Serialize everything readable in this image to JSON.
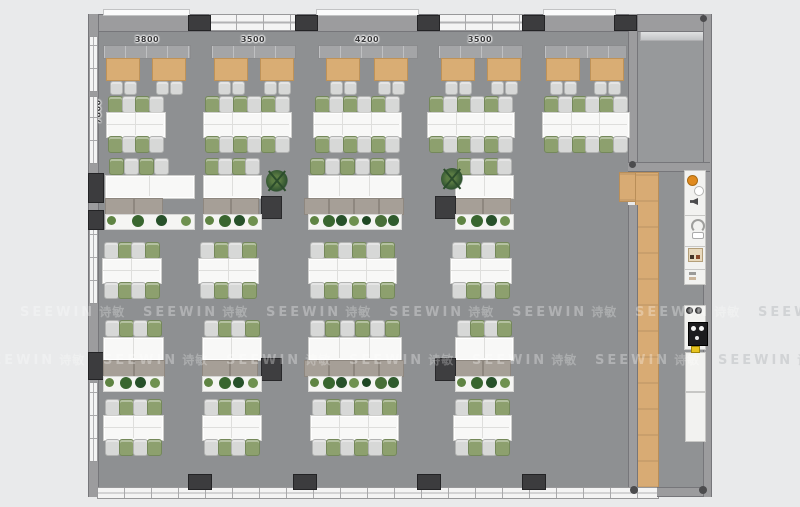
{
  "meta": {
    "type": "office-floor-plan-top-view"
  },
  "watermark": {
    "text": "SEEWIN",
    "cjk": "诗敏"
  },
  "dimensions": {
    "top": [
      "3800",
      "3500",
      "4200",
      "3500"
    ],
    "left": "7800"
  },
  "palette": {
    "bg": "#e9eaeb",
    "floor": "#8e9092",
    "room_floor": "#97999b",
    "wall": "#9c9c9e",
    "pillar": "#3c3c3e",
    "desk": "#f8f8f7",
    "chair_gray": "#d7d8d7",
    "chair_green": "#8da06e",
    "booth_table": "#d9ad74",
    "bench": "#a4a5a7",
    "cabinet": "#a69f97",
    "dark_cabinet": "#3e3e40",
    "wood": "#d8ab74",
    "planter": "#f5f5f3",
    "accent_orange": "#e08a1e",
    "window": "#f4f4f4"
  },
  "floorplan": {
    "booths": {
      "bench_y": 45,
      "bench_h": 12,
      "table_y": 58,
      "table_w": 32,
      "table_h": 21,
      "chair_y": 81,
      "bays": [
        {
          "bench_x": 103,
          "bench_w": 86,
          "tables": [
            106,
            152
          ]
        },
        {
          "bench_x": 211,
          "bench_w": 83,
          "tables": [
            214,
            260
          ]
        },
        {
          "bench_x": 318,
          "bench_w": 98,
          "tables": [
            326,
            374
          ]
        },
        {
          "bench_x": 438,
          "bench_w": 83,
          "tables": [
            441,
            487
          ]
        },
        {
          "bench_x": 544,
          "bench_w": 81,
          "tables": [
            546,
            590
          ]
        }
      ]
    },
    "rows_double": [
      {
        "y": 96,
        "start": "g",
        "clusters": [
          {
            "x": 106,
            "w": 58,
            "seats": 4
          },
          {
            "x": 203,
            "w": 87,
            "seats": 6
          },
          {
            "x": 313,
            "w": 87,
            "seats": 6
          },
          {
            "x": 427,
            "w": 86,
            "seats": 6
          },
          {
            "x": 542,
            "w": 86,
            "seats": 6
          }
        ]
      },
      {
        "y": 242,
        "start": "s",
        "clusters": [
          {
            "x": 102,
            "w": 58,
            "seats": 4
          },
          {
            "x": 198,
            "w": 59,
            "seats": 4
          },
          {
            "x": 308,
            "w": 87,
            "seats": 6
          },
          {
            "x": 450,
            "w": 60,
            "seats": 4
          }
        ]
      },
      {
        "y": 399,
        "start": "s",
        "clusters": [
          {
            "x": 103,
            "w": 59,
            "seats": 4
          },
          {
            "x": 202,
            "w": 58,
            "seats": 4
          },
          {
            "x": 310,
            "w": 87,
            "seats": 6
          },
          {
            "x": 453,
            "w": 57,
            "seats": 4
          }
        ]
      }
    ],
    "rows_single": [
      {
        "y": 158,
        "start": "g",
        "clusters": [
          {
            "x": 105,
            "w": 88,
            "seats": 4,
            "chair_w": 62,
            "cab_w": 58,
            "plants": 4
          },
          {
            "x": 203,
            "w": 57,
            "seats": 4,
            "cab_w": 55,
            "plants": 4,
            "dark": "right"
          },
          {
            "x": 308,
            "w": 92,
            "seats": 6,
            "cab_w": 100,
            "cab_dx": -4,
            "plants": 7
          },
          {
            "x": 455,
            "w": 57,
            "seats": 4,
            "cab_w": 55,
            "plants": 4,
            "dark": "left"
          }
        ]
      },
      {
        "y": 320,
        "start": "s",
        "clusters": [
          {
            "x": 103,
            "w": 59,
            "seats": 4,
            "cab_w": 62,
            "plants": 4
          },
          {
            "x": 202,
            "w": 58,
            "seats": 4,
            "cab_w": 55,
            "plants": 4,
            "dark": "right"
          },
          {
            "x": 308,
            "w": 92,
            "seats": 6,
            "cab_w": 100,
            "cab_dx": -4,
            "plants": 7
          },
          {
            "x": 455,
            "w": 57,
            "seats": 4,
            "cab_w": 55,
            "plants": 4,
            "dark": "left"
          }
        ]
      }
    ],
    "plants_standalone": [
      {
        "x": 266,
        "y": 170
      },
      {
        "x": 441,
        "y": 168
      }
    ],
    "pillars_top": [
      188,
      295,
      417,
      522,
      614
    ],
    "pillars_bottom": [
      188,
      293,
      417,
      522
    ],
    "pillars_left": [
      [
        173,
        28
      ],
      [
        210,
        18
      ],
      [
        352,
        26
      ]
    ],
    "windows_top": [
      [
        209,
        86
      ],
      [
        438,
        84
      ]
    ],
    "sills_top": [
      [
        103,
        85
      ],
      [
        316,
        101
      ],
      [
        543,
        71
      ]
    ],
    "windows_left": [
      [
        36,
        54
      ],
      [
        96,
        66
      ],
      [
        228,
        74
      ],
      [
        382,
        78
      ]
    ],
    "plant_colors": [
      "#5f8443",
      "#39662f",
      "#27512a",
      "#6f9150",
      "#1e4723",
      "#486f38",
      "#2f5b2d"
    ],
    "watermarks": [
      {
        "y": 303,
        "xs": [
          20,
          143,
          266,
          389,
          512,
          635,
          758
        ]
      },
      {
        "y": 351,
        "xs": [
          -20,
          103,
          226,
          349,
          472,
          595,
          718
        ]
      }
    ]
  }
}
